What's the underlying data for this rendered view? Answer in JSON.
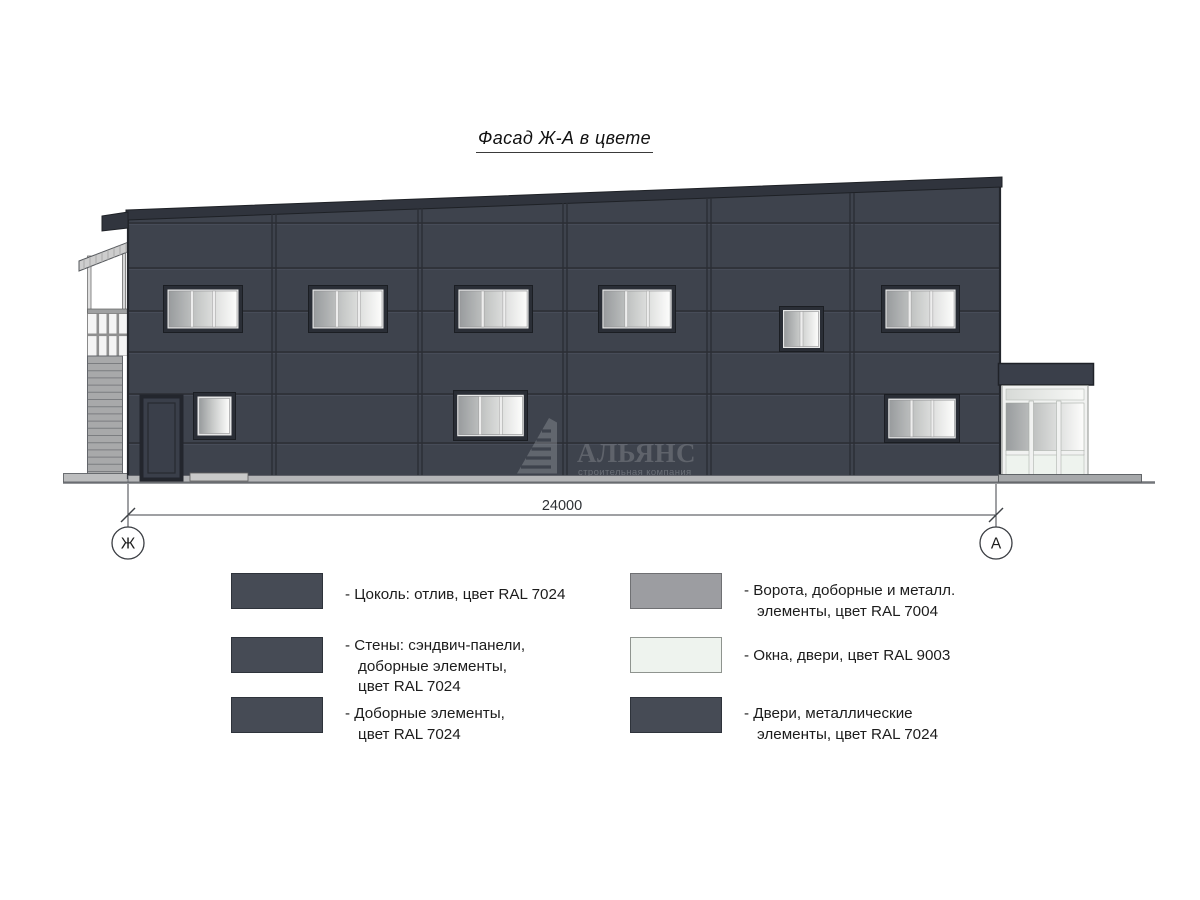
{
  "title": {
    "text": "Фасад Ж-А в цвете"
  },
  "drawing": {
    "dimension_label": "24000",
    "axis_left": "Ж",
    "axis_right": "А",
    "watermark_name": "АЛЬЯНС",
    "watermark_subtitle": "строительная компания"
  },
  "colors": {
    "facade_ral7024": "#3e434d",
    "trim_dark": "#30343d",
    "metal_ral7004": "#9c9da1",
    "windows_ral9003": "#eef3ee",
    "legend_dark": "#464b55",
    "ground_line": "#73767a"
  },
  "legend": {
    "left": [
      {
        "swatch": "#464b55",
        "lines": [
          "- Цоколь: отлив, цвет RAL 7024"
        ]
      },
      {
        "swatch": "#464b55",
        "lines": [
          "- Стены: сэндвич-панели,",
          "доборные элементы,",
          "цвет RAL 7024"
        ]
      },
      {
        "swatch": "#464b55",
        "lines": [
          "- Доборные элементы,",
          "цвет RAL 7024"
        ]
      }
    ],
    "right": [
      {
        "swatch": "#9c9da1",
        "lines": [
          "- Ворота, доборные и металл.",
          "элементы, цвет RAL 7004"
        ]
      },
      {
        "swatch": "#eef3ee",
        "lines": [
          "- Окна, двери, цвет RAL 9003"
        ]
      },
      {
        "swatch": "#464b55",
        "lines": [
          "- Двери, металлические",
          "элементы, цвет RAL 7024"
        ]
      }
    ]
  }
}
